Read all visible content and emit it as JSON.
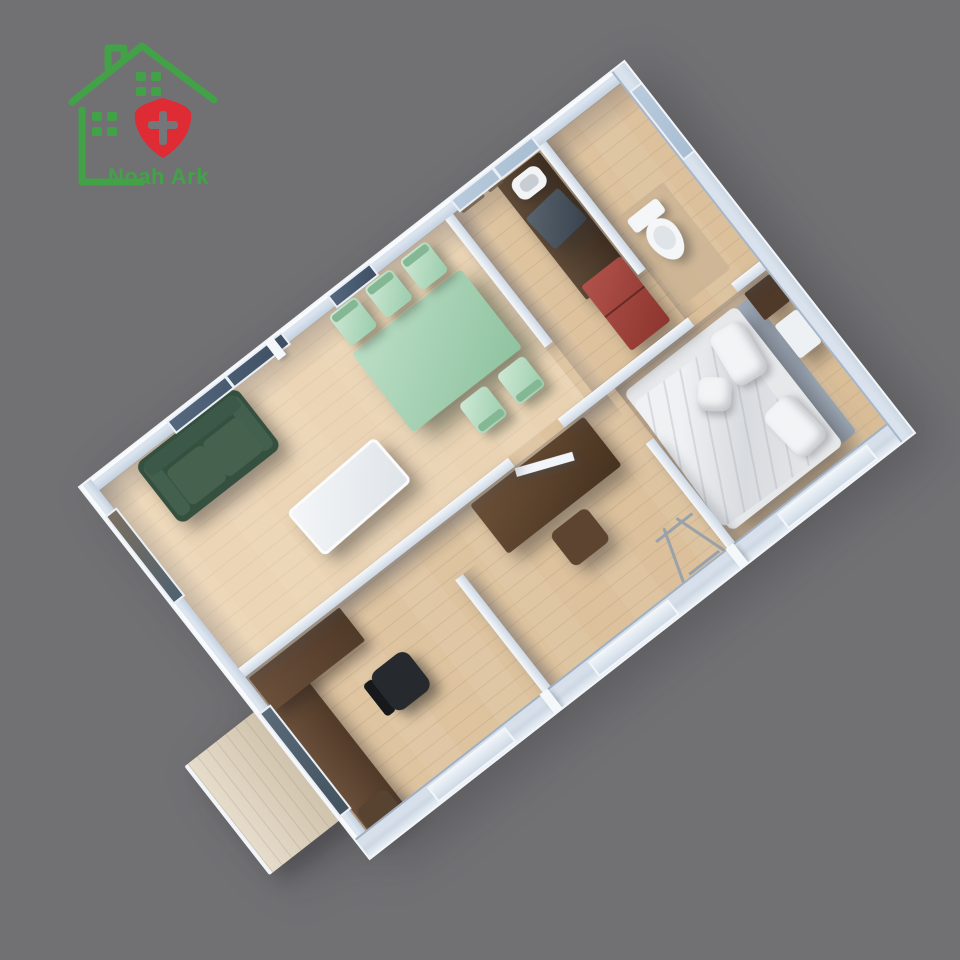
{
  "logo": {
    "brand": "Noah Ark"
  },
  "colors": {
    "background": "#717174",
    "wall_face": "#c3d0e0",
    "wall_outer": "#cdd8e4",
    "floor_wood": "#e2c9a6",
    "floor_wood_dark": "#d9bd97",
    "glass_dark": "#3e4f63",
    "glass_light": "#a9bed2",
    "sofa_green": "#35503f",
    "dining_mint": "#8fc3a0",
    "chair_mint": "#9accab",
    "bed_linen": "#e6e8ea",
    "headboard_gray": "#a2aebc",
    "wood_walnut": "#46321f",
    "wood_counter": "#3f2f22",
    "fridge_red": "#8c352e",
    "appliance_dark": "#39424d",
    "chair_black": "#26292d",
    "porch_wood": "#cfc2ab",
    "toilet_white": "#f4f6f8",
    "logo_green": "#43a147",
    "logo_red": "#de2b34",
    "logo_cross": "#75767a"
  },
  "scene": {
    "type": "isometric 3D floor-plan render of an expandable container house",
    "rooms": [
      {
        "name": "living-dining-room",
        "furniture": [
          "green-sofa",
          "white-coffee-table",
          "mint-dining-table",
          "five-mint-chairs"
        ]
      },
      {
        "name": "kitchen",
        "furniture": [
          "wood-counter",
          "rice-cooker",
          "dark-appliance",
          "red-fridge"
        ]
      },
      {
        "name": "bathroom",
        "furniture": [
          "toilet"
        ]
      },
      {
        "name": "bedroom",
        "furniture": [
          "double-bed",
          "pillows",
          "headboard",
          "nightstand",
          "bench"
        ]
      },
      {
        "name": "study-corridor",
        "furniture": [
          "walnut-desk",
          "stool",
          "clothes-rack",
          "open-door"
        ]
      },
      {
        "name": "office",
        "furniture": [
          "l-shaped-desk",
          "black-office-chair",
          "shelf"
        ]
      },
      {
        "name": "exterior",
        "furniture": [
          "entry-porch-deck"
        ]
      }
    ]
  }
}
